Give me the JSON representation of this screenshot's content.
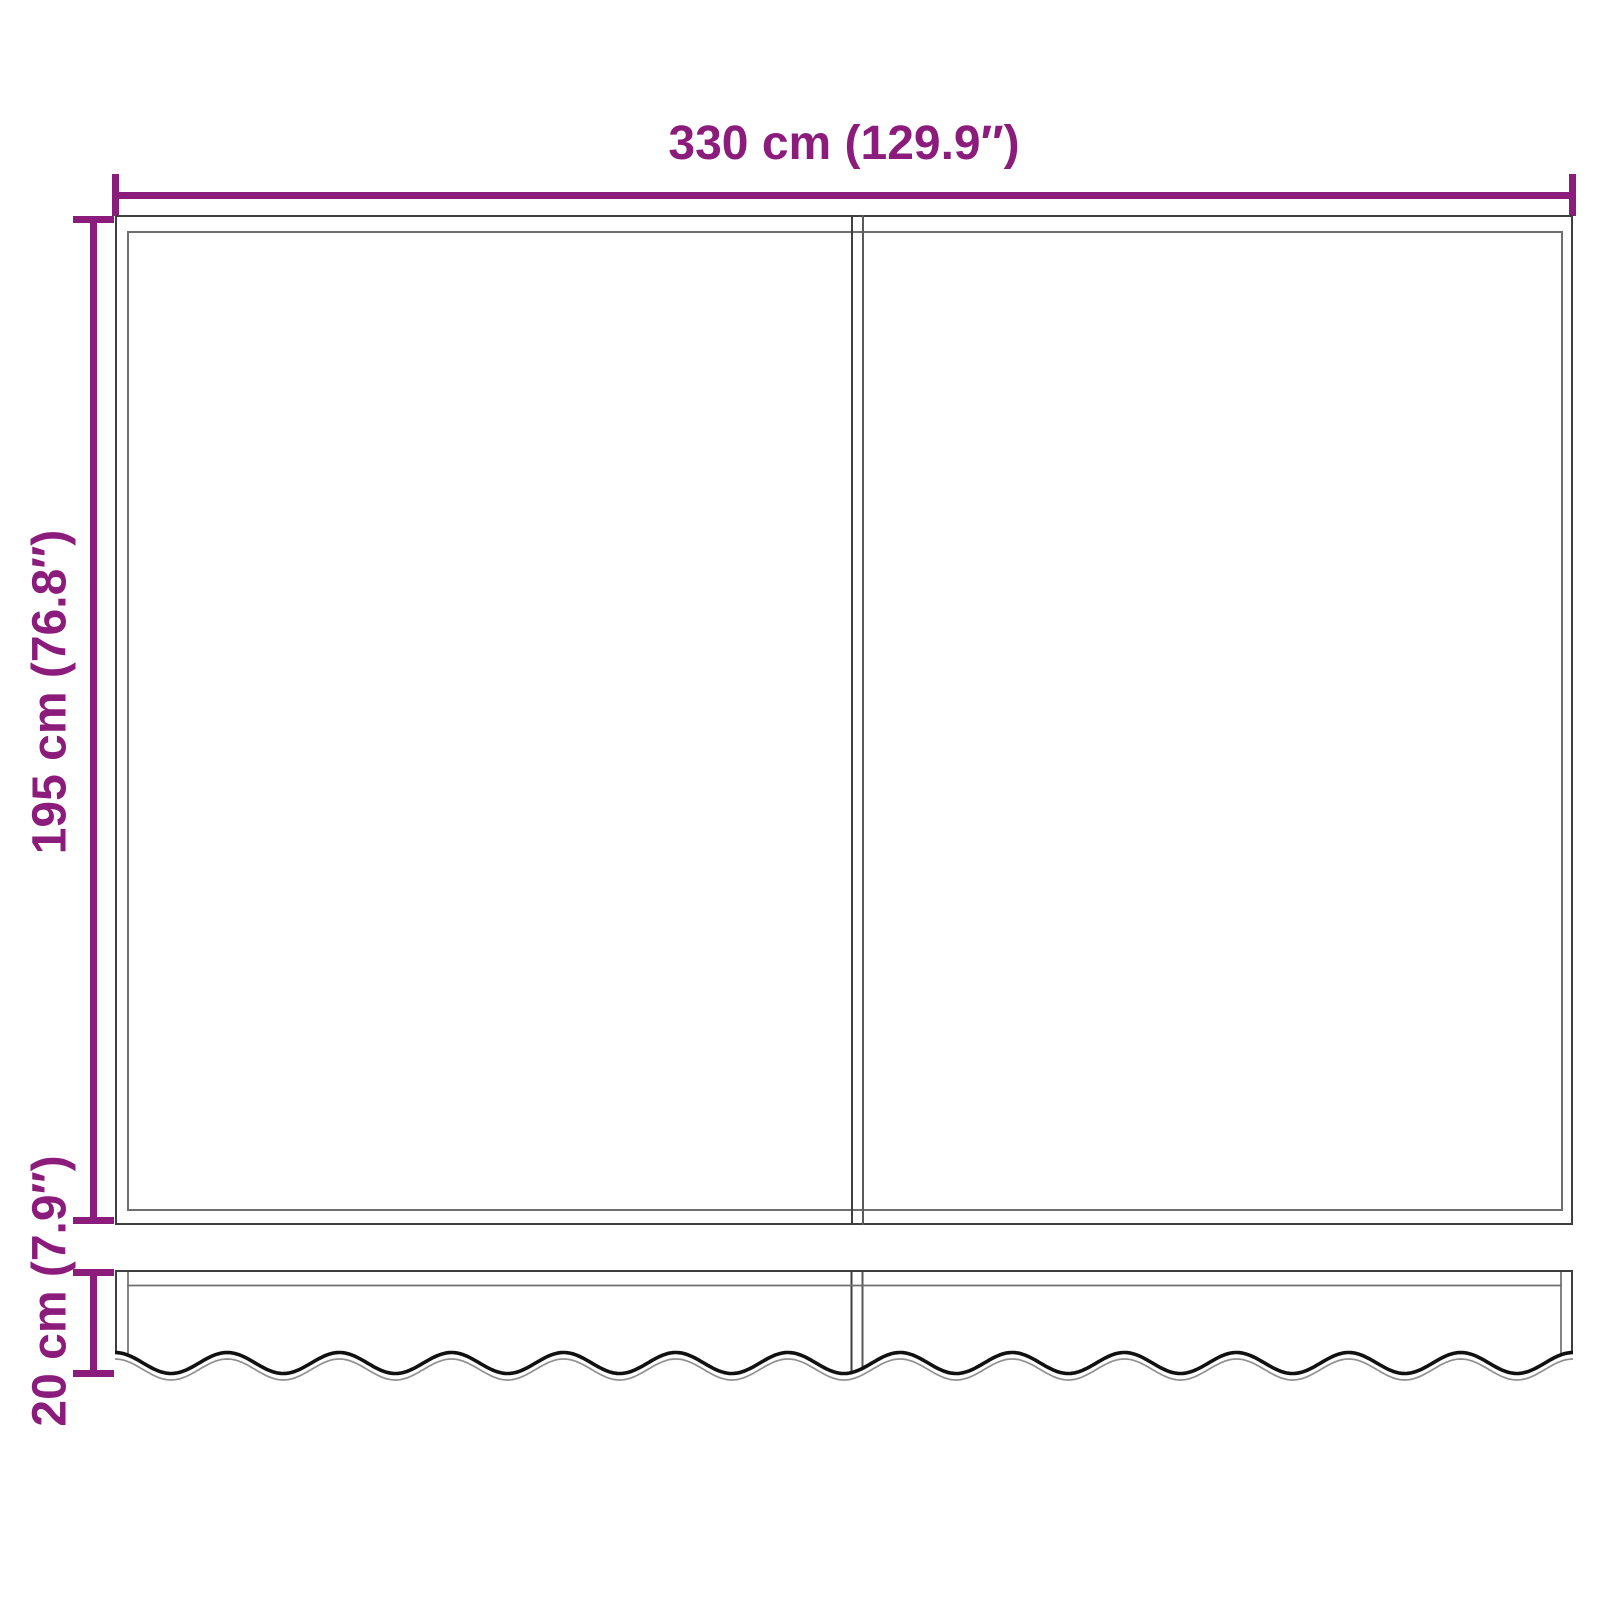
{
  "diagram": {
    "title": "Awning fabric with valance — dimension diagram",
    "accent_color": "#8C1C7C",
    "outline_color": "#3F3F3F",
    "inner_line_color": "#6E6E6E",
    "hem_color": "#111111",
    "hem_shadow_color": "#909090",
    "width_dim": {
      "label": "330 cm (129.9″)",
      "value_cm": 330,
      "value_in": 129.9
    },
    "height_dim": {
      "label": "195 cm (76.8″)",
      "value_cm": 195,
      "value_in": 76.8
    },
    "valance_dim": {
      "label": "20 cm (7.9″)",
      "value_cm": 20,
      "value_in": 7.9
    }
  }
}
